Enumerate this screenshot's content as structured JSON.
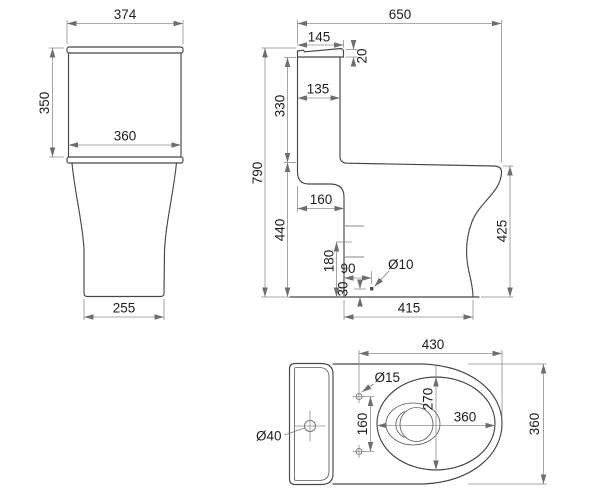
{
  "colors": {
    "background": "#ffffff",
    "outline": "#474747",
    "dimension_lines": "#8f8f8f",
    "text": "#1d1d1d"
  },
  "views": {
    "front": {
      "dims": {
        "lid_width": "374",
        "tank_height": "350",
        "tank_width": "360",
        "base_width": "255"
      }
    },
    "side": {
      "dims": {
        "total_depth": "650",
        "lid_depth": "145",
        "lid_thickness": "20",
        "tank_depth": "135",
        "tank_section_height": "330",
        "total_height": "790",
        "bowl_section_height": "440",
        "rear_recess_depth": "160",
        "outlet_center_height": "180",
        "fixing_hole_offset": "90",
        "fixing_hole_diameter": "Ø10",
        "fixing_hole_height": "30",
        "base_depth": "415",
        "rim_height": "425"
      }
    },
    "top": {
      "dims": {
        "bowl_length": "430",
        "seat_hole_diameter": "Ø15",
        "bowl_inner_width": "270",
        "bowl_inner_length": "360",
        "overall_width": "360",
        "seat_hole_spacing": "160",
        "tank_hole_diameter": "Ø40"
      }
    }
  }
}
